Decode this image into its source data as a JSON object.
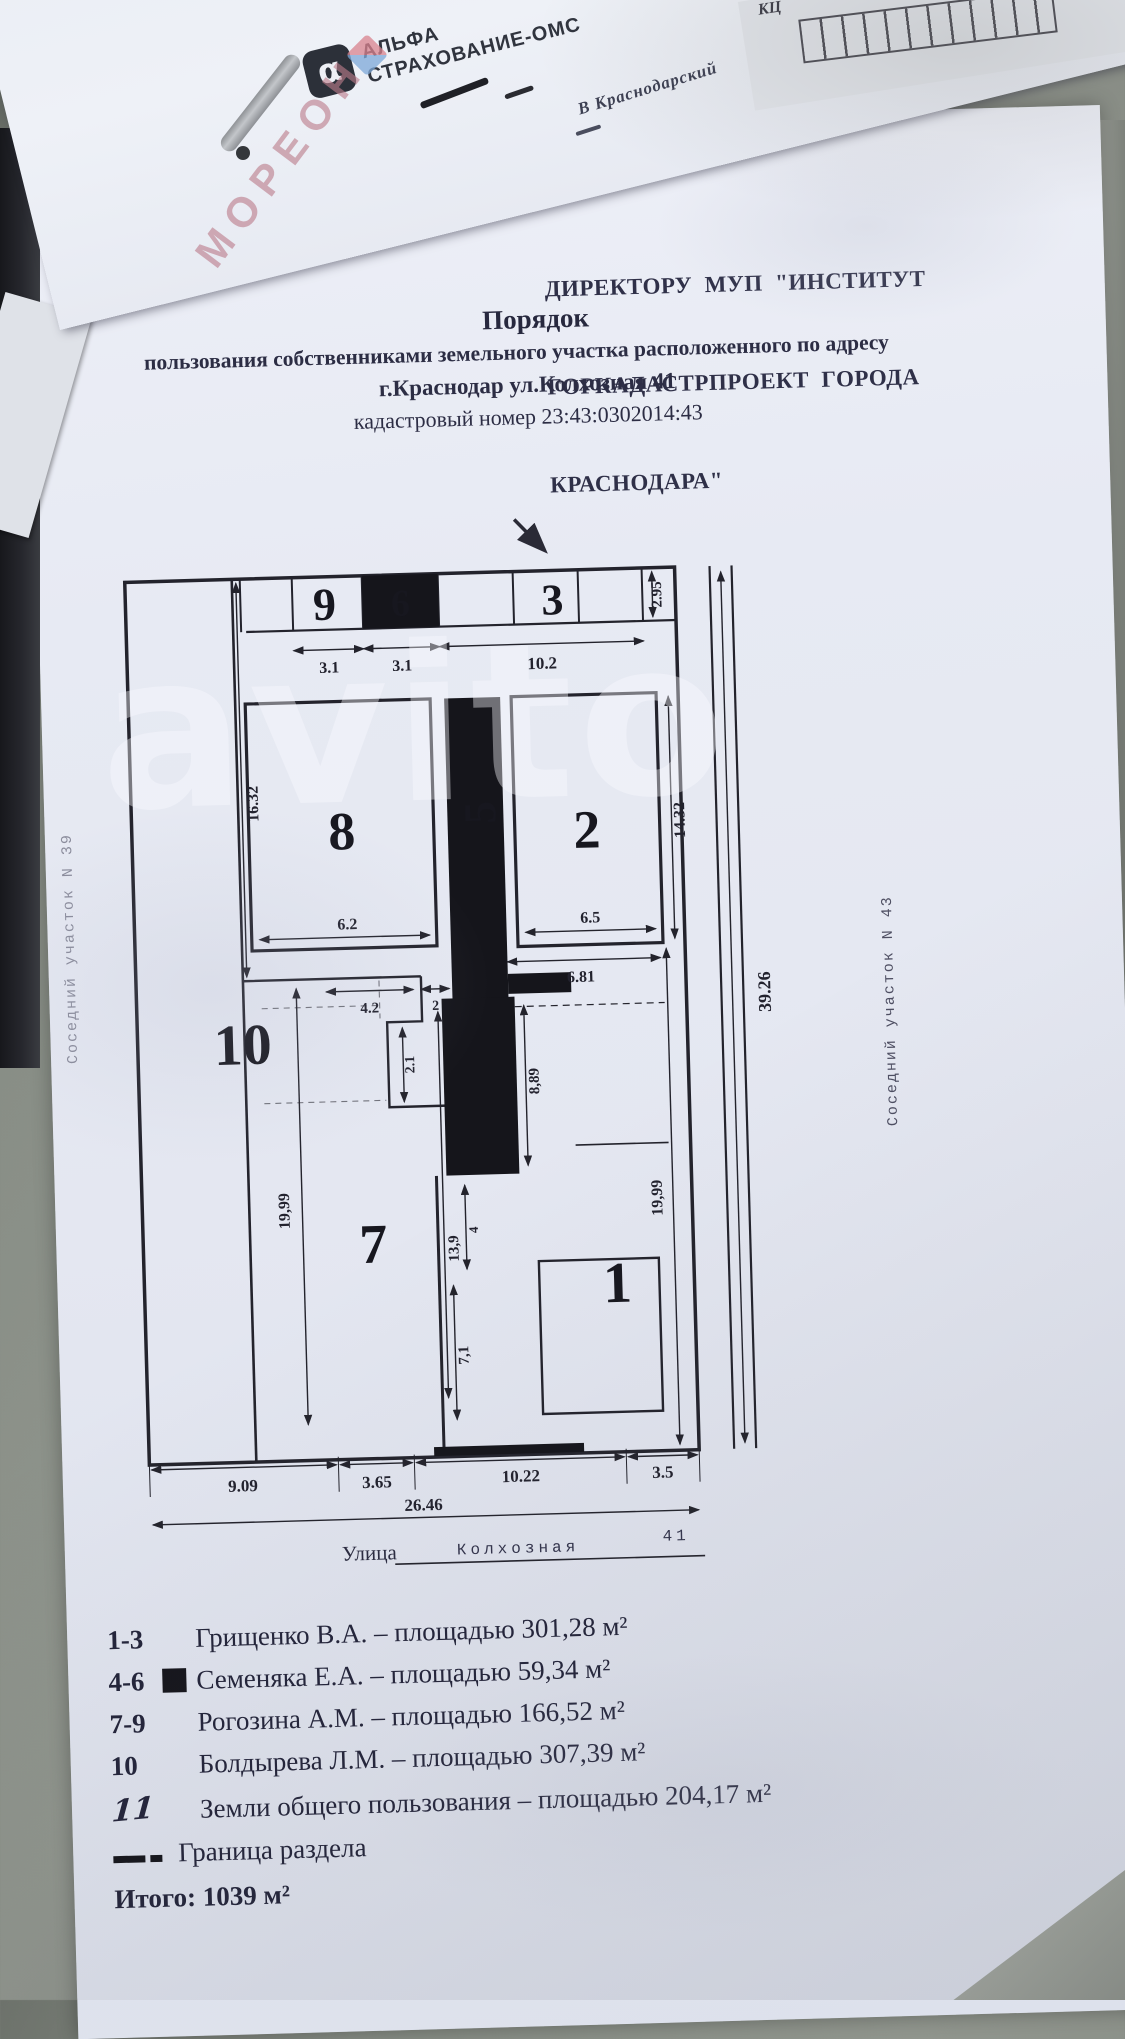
{
  "photo": {
    "alpha_logo": {
      "symbol": "α",
      "line1": "АЛЬФА",
      "line2": "СТРАХОВАНИЕ-ОМС"
    },
    "handwriting": "В Краснодарский",
    "corner_note": "КЦ",
    "watermark_moreon": "МОРЕОН",
    "watermark_avito": "avito"
  },
  "document": {
    "addressee_lines": [
      "ДИРЕКТОРУ  МУП  \"ИНСТИТУТ",
      "ГОРКАДАСТРПРОЕКТ  ГОРОДА",
      "КРАСНОДАРА\""
    ],
    "title": "Порядок",
    "subtitle": "пользования собственниками земельного участка расположенного по адресу",
    "address_line": "г.Краснодар ул.Колхозная 41",
    "cadastre_line": "кадастровый номер 23:43:0302014:43",
    "plan": {
      "plots": {
        "p1": "1",
        "p2": "2",
        "p3": "3",
        "p5": "5",
        "p6": "6",
        "p7": "7",
        "p8": "8",
        "p9": "9",
        "p10": "10"
      },
      "dims": {
        "t31a": "3.1",
        "t31b": "3.1",
        "t102": "10.2",
        "v295": "2.95",
        "v1632": "16.32",
        "w62": "6.2",
        "w65": "6.5",
        "v1432": "14.32",
        "w681": "6.81",
        "w42": "4.2",
        "w2": "2",
        "v21": "2.1",
        "v889": "8,89",
        "l1999": "19,99",
        "v139": "13,9",
        "v4": "4",
        "v71": "7,1",
        "r1999": "19,99",
        "v3926": "39.26",
        "b909": "9.09",
        "b365": "3.65",
        "b1022": "10.22",
        "b35": "3.5",
        "b2646": "26.46"
      },
      "left_neighbor": "Соседний участок N  39",
      "right_neighbor": "Соседний участок N  43",
      "street": {
        "label": "Улица",
        "name": "Колхозная",
        "number": "41"
      }
    },
    "legend": {
      "rows": [
        {
          "key": "1-3",
          "text": "Грищенко В.А. – площадью 301,28 м²"
        },
        {
          "key": "4-6",
          "text": "Семеняка Е.А. – площадью 59,34 м²"
        },
        {
          "key": "7-9",
          "text": "Рогозина А.М. – площадью 166,52 м²"
        },
        {
          "key": "10",
          "text": "Болдырева Л.М. – площадью 307,39 м²"
        },
        {
          "key": "11",
          "text": "Земли общего пользования – площадью 204,17 м²"
        }
      ],
      "boundary_label": "Граница раздела",
      "total": "Итого: 1039 м²"
    }
  }
}
